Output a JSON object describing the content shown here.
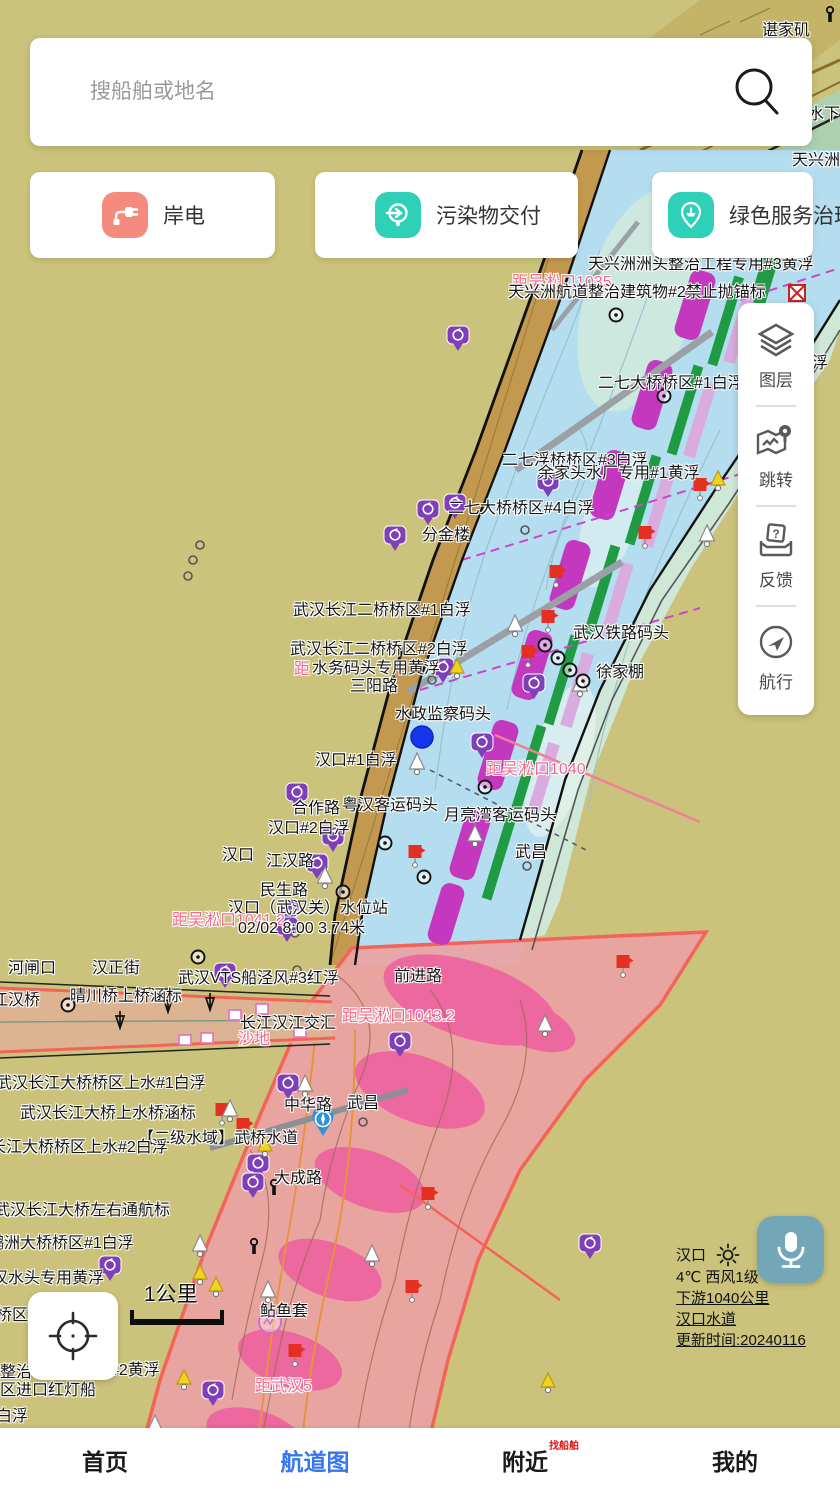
{
  "search": {
    "placeholder": "搜船舶或地名",
    "icon": "search-icon"
  },
  "quick_actions": [
    {
      "label": "岸电",
      "icon": "shore-power-plug-icon",
      "icon_color": "#f58a7e"
    },
    {
      "label": "污染物交付",
      "icon": "pollutant-delivery-icon",
      "icon_color": "#2ed1b8"
    },
    {
      "label": "绿色服务治理",
      "icon": "green-service-ship-icon",
      "icon_color": "#2ed1b8"
    }
  ],
  "tool_panel": [
    {
      "label": "图层",
      "icon": "layers-icon"
    },
    {
      "label": "跳转",
      "icon": "jump-map-pin-icon"
    },
    {
      "label": "反馈",
      "icon": "feedback-inbox-icon"
    },
    {
      "label": "航行",
      "icon": "navigate-compass-icon"
    }
  ],
  "weather": {
    "station": "汉口",
    "weather_icon": "sun-icon",
    "temp_wind": "4℃ 西风1级",
    "downstream": "下游1040公里",
    "waterway": "汉口水道",
    "updated": "更新时间:20240116"
  },
  "scale_bar": {
    "label": "1公里"
  },
  "mic_button": {
    "icon": "microphone-icon",
    "color": "#73a7b7"
  },
  "locate_button": {
    "icon": "crosshair-icon"
  },
  "bottom_nav": [
    {
      "label": "首页",
      "active": false
    },
    {
      "label": "航道图",
      "active": true
    },
    {
      "label": "附近",
      "active": false,
      "badge": "找船舶"
    },
    {
      "label": "我的",
      "active": false
    }
  ],
  "colors": {
    "accent_blue": "#3677f0",
    "distance_pink": "#f0688e",
    "map_bg": "#cbc37b",
    "channel_magenta": "#c438c0",
    "danger_zone": "#e9a3a3"
  },
  "map_labels": [
    {
      "t": "谌家矶",
      "x": 762,
      "y": 22,
      "type": "place"
    },
    {
      "t": "水下",
      "x": 808,
      "y": 106,
      "type": "place"
    },
    {
      "t": "天兴洲",
      "x": 792,
      "y": 152,
      "type": "place"
    },
    {
      "t": "天兴洲洲头整治工程专用#3黄浮",
      "x": 588,
      "y": 256,
      "type": "place"
    },
    {
      "t": "距吴淞口1035",
      "x": 512,
      "y": 274,
      "type": "distance"
    },
    {
      "t": "天兴洲航道整治建筑物#2禁止抛锚标",
      "x": 508,
      "y": 284,
      "type": "place"
    },
    {
      "t": "二七大桥桥区#1白浮",
      "x": 598,
      "y": 375,
      "type": "place"
    },
    {
      "t": "浮",
      "x": 812,
      "y": 355,
      "type": "place"
    },
    {
      "t": "二七浮桥桥区#3白浮",
      "x": 502,
      "y": 452,
      "type": "place"
    },
    {
      "t": "余家头水厂专用#1黄浮",
      "x": 538,
      "y": 465,
      "type": "place"
    },
    {
      "t": "二七大桥桥区#4白浮",
      "x": 448,
      "y": 500,
      "type": "place"
    },
    {
      "t": "分金楼",
      "x": 422,
      "y": 527,
      "type": "place"
    },
    {
      "t": "武汉长江二桥桥区#1白浮",
      "x": 293,
      "y": 602,
      "type": "place"
    },
    {
      "t": "武汉铁路码头",
      "x": 573,
      "y": 625,
      "type": "place"
    },
    {
      "t": "武汉长江二桥桥区#2白浮",
      "x": 290,
      "y": 641,
      "type": "place"
    },
    {
      "t": "距",
      "x": 294,
      "y": 661,
      "type": "distance"
    },
    {
      "t": "水务码头专用黄浮",
      "x": 312,
      "y": 660,
      "type": "place"
    },
    {
      "t": "徐家棚",
      "x": 596,
      "y": 664,
      "type": "place"
    },
    {
      "t": "三阳路",
      "x": 350,
      "y": 678,
      "type": "place"
    },
    {
      "t": "水政监察码头",
      "x": 395,
      "y": 706,
      "type": "place"
    },
    {
      "t": "汉口#1白浮",
      "x": 315,
      "y": 752,
      "type": "place"
    },
    {
      "t": "距吴淞口1040",
      "x": 486,
      "y": 761,
      "type": "distance"
    },
    {
      "t": "合作路",
      "x": 292,
      "y": 800,
      "type": "place"
    },
    {
      "t": "粤汉客运码头",
      "x": 342,
      "y": 797,
      "type": "place"
    },
    {
      "t": "月亮湾客运码头",
      "x": 444,
      "y": 807,
      "type": "place"
    },
    {
      "t": "汉口#2白浮",
      "x": 268,
      "y": 820,
      "type": "place"
    },
    {
      "t": "武昌",
      "x": 515,
      "y": 844,
      "type": "place"
    },
    {
      "t": "汉口",
      "x": 222,
      "y": 847,
      "type": "place"
    },
    {
      "t": "江汉路",
      "x": 266,
      "y": 853,
      "type": "place"
    },
    {
      "t": "民生路",
      "x": 260,
      "y": 882,
      "type": "place"
    },
    {
      "t": "汉口（武汉关）水位站",
      "x": 228,
      "y": 900,
      "type": "place"
    },
    {
      "t": "距吴淞口1041.2",
      "x": 172,
      "y": 912,
      "type": "distance"
    },
    {
      "t": "02/02 8:00 3.74米",
      "x": 238,
      "y": 920,
      "type": "place"
    },
    {
      "t": "河闸口",
      "x": 8,
      "y": 960,
      "type": "place"
    },
    {
      "t": "汉正街",
      "x": 92,
      "y": 960,
      "type": "place"
    },
    {
      "t": "武汉VTS船泾风#3红浮",
      "x": 178,
      "y": 970,
      "type": "place"
    },
    {
      "t": "前进路",
      "x": 394,
      "y": 968,
      "type": "place"
    },
    {
      "t": "晴川桥上桥涵标",
      "x": 70,
      "y": 988,
      "type": "place"
    },
    {
      "t": "江汉桥",
      "x": -8,
      "y": 992,
      "type": "place"
    },
    {
      "t": "长江汉江交汇",
      "x": 240,
      "y": 1015,
      "type": "place"
    },
    {
      "t": "距吴淞口1043.2",
      "x": 342,
      "y": 1008,
      "type": "distance"
    },
    {
      "t": "沙地",
      "x": 238,
      "y": 1031,
      "type": "distance"
    },
    {
      "t": "武汉长江大桥桥区上水#1白浮",
      "x": -4,
      "y": 1075,
      "type": "place"
    },
    {
      "t": "中华路",
      "x": 284,
      "y": 1097,
      "type": "place"
    },
    {
      "t": "武昌",
      "x": 347,
      "y": 1095,
      "type": "place"
    },
    {
      "t": "武汉长江大桥上水桥涵标",
      "x": 20,
      "y": 1105,
      "type": "place"
    },
    {
      "t": "【二级水域】武桥水道",
      "x": 138,
      "y": 1130,
      "type": "place"
    },
    {
      "t": "长江大桥桥区上水#2白浮",
      "x": -10,
      "y": 1139,
      "type": "place"
    },
    {
      "t": "大成路",
      "x": 274,
      "y": 1170,
      "type": "place"
    },
    {
      "t": "武汉长江大桥左右通航标",
      "x": -6,
      "y": 1202,
      "type": "place"
    },
    {
      "t": "鹦洲大桥桥区#1白浮",
      "x": -12,
      "y": 1235,
      "type": "place"
    },
    {
      "t": "汉水头专用黄浮",
      "x": -8,
      "y": 1270,
      "type": "place"
    },
    {
      "t": "桥区",
      "x": -4,
      "y": 1307,
      "type": "place"
    },
    {
      "t": "鲇鱼套",
      "x": 260,
      "y": 1303,
      "type": "place"
    },
    {
      "t": "整治",
      "x": 0,
      "y": 1364,
      "type": "place"
    },
    {
      "t": "#2黄浮",
      "x": 110,
      "y": 1362,
      "type": "place"
    },
    {
      "t": "区进口红灯船",
      "x": 0,
      "y": 1382,
      "type": "place"
    },
    {
      "t": "距武汉5",
      "x": 255,
      "y": 1378,
      "type": "distance"
    },
    {
      "t": "白浮",
      "x": -4,
      "y": 1408,
      "type": "place"
    }
  ],
  "map_markers": [
    {
      "type": "blue-dot",
      "x": 422,
      "y": 737
    },
    {
      "type": "blue-pin",
      "x": 323,
      "y": 1136
    },
    {
      "type": "no-anchor",
      "x": 797,
      "y": 293
    },
    {
      "type": "purple-pin",
      "x": 458,
      "y": 352
    },
    {
      "type": "purple-pin",
      "x": 548,
      "y": 498
    },
    {
      "type": "purple-pin",
      "x": 455,
      "y": 520
    },
    {
      "type": "purple-pin",
      "x": 428,
      "y": 526
    },
    {
      "type": "purple-pin",
      "x": 395,
      "y": 552
    },
    {
      "type": "purple-pin",
      "x": 443,
      "y": 684
    },
    {
      "type": "purple-pin",
      "x": 534,
      "y": 700
    },
    {
      "type": "purple-pin",
      "x": 482,
      "y": 759
    },
    {
      "type": "purple-pin",
      "x": 297,
      "y": 809
    },
    {
      "type": "purple-pin",
      "x": 333,
      "y": 853
    },
    {
      "type": "purple-pin",
      "x": 317,
      "y": 880
    },
    {
      "type": "purple-pin",
      "x": 288,
      "y": 925
    },
    {
      "type": "purple-pin",
      "x": 287,
      "y": 943
    },
    {
      "type": "purple-pin",
      "x": 225,
      "y": 989
    },
    {
      "type": "purple-pin",
      "x": 400,
      "y": 1058
    },
    {
      "type": "purple-pin",
      "x": 288,
      "y": 1100
    },
    {
      "type": "purple-pin",
      "x": 258,
      "y": 1180
    },
    {
      "type": "purple-pin",
      "x": 253,
      "y": 1199
    },
    {
      "type": "purple-pin",
      "x": 110,
      "y": 1282
    },
    {
      "type": "purple-pin",
      "x": 213,
      "y": 1407
    },
    {
      "type": "purple-pin",
      "x": 590,
      "y": 1260
    },
    {
      "type": "red-flag",
      "x": 645,
      "y": 545
    },
    {
      "type": "red-flag",
      "x": 548,
      "y": 629
    },
    {
      "type": "red-flag",
      "x": 528,
      "y": 664
    },
    {
      "type": "red-flag",
      "x": 700,
      "y": 497
    },
    {
      "type": "red-flag",
      "x": 415,
      "y": 864
    },
    {
      "type": "red-flag",
      "x": 623,
      "y": 974
    },
    {
      "type": "red-flag",
      "x": 222,
      "y": 1122
    },
    {
      "type": "red-flag",
      "x": 243,
      "y": 1137
    },
    {
      "type": "red-flag",
      "x": 428,
      "y": 1206
    },
    {
      "type": "red-flag",
      "x": 412,
      "y": 1299
    },
    {
      "type": "red-flag",
      "x": 295,
      "y": 1363
    },
    {
      "type": "red-flag",
      "x": 556,
      "y": 584
    },
    {
      "type": "white-sail",
      "x": 417,
      "y": 768
    },
    {
      "type": "white-sail",
      "x": 515,
      "y": 630
    },
    {
      "type": "white-sail",
      "x": 580,
      "y": 690
    },
    {
      "type": "white-sail",
      "x": 475,
      "y": 840
    },
    {
      "type": "white-sail",
      "x": 325,
      "y": 882
    },
    {
      "type": "white-sail",
      "x": 707,
      "y": 540
    },
    {
      "type": "white-sail",
      "x": 305,
      "y": 1090
    },
    {
      "type": "white-sail",
      "x": 230,
      "y": 1115
    },
    {
      "type": "white-sail",
      "x": 200,
      "y": 1250
    },
    {
      "type": "white-sail",
      "x": 155,
      "y": 1430
    },
    {
      "type": "white-sail",
      "x": 372,
      "y": 1260
    },
    {
      "type": "white-sail",
      "x": 545,
      "y": 1030
    },
    {
      "type": "white-sail",
      "x": 268,
      "y": 1296
    },
    {
      "type": "yellow-warn",
      "x": 718,
      "y": 484
    },
    {
      "type": "yellow-warn",
      "x": 457,
      "y": 672
    },
    {
      "type": "yellow-warn",
      "x": 265,
      "y": 1150
    },
    {
      "type": "yellow-warn",
      "x": 200,
      "y": 1278
    },
    {
      "type": "yellow-warn",
      "x": 216,
      "y": 1290
    },
    {
      "type": "yellow-warn",
      "x": 184,
      "y": 1383
    },
    {
      "type": "yellow-warn",
      "x": 548,
      "y": 1386
    },
    {
      "type": "circle-plus",
      "x": 616,
      "y": 315
    },
    {
      "type": "circle-plus",
      "x": 664,
      "y": 396
    },
    {
      "type": "circle-plus",
      "x": 545,
      "y": 645
    },
    {
      "type": "circle-plus",
      "x": 558,
      "y": 658
    },
    {
      "type": "circle-plus",
      "x": 570,
      "y": 670
    },
    {
      "type": "circle-plus",
      "x": 583,
      "y": 681
    },
    {
      "type": "circle-plus",
      "x": 68,
      "y": 1005
    },
    {
      "type": "circle-plus",
      "x": 198,
      "y": 957
    },
    {
      "type": "circle-plus",
      "x": 343,
      "y": 892
    },
    {
      "type": "circle-plus",
      "x": 424,
      "y": 877
    },
    {
      "type": "circle-plus",
      "x": 485,
      "y": 787
    },
    {
      "type": "circle-plus",
      "x": 385,
      "y": 843
    },
    {
      "type": "dot",
      "x": 200,
      "y": 545
    },
    {
      "type": "dot",
      "x": 193,
      "y": 560
    },
    {
      "type": "dot",
      "x": 188,
      "y": 576
    },
    {
      "type": "dot",
      "x": 295,
      "y": 933
    },
    {
      "type": "dot",
      "x": 432,
      "y": 680
    },
    {
      "type": "dot",
      "x": 525,
      "y": 530
    },
    {
      "type": "dot",
      "x": 527,
      "y": 866
    },
    {
      "type": "dot",
      "x": 363,
      "y": 1122
    },
    {
      "type": "dot",
      "x": 297,
      "y": 970
    },
    {
      "type": "bollard",
      "x": 274,
      "y": 1195
    },
    {
      "type": "bollard",
      "x": 254,
      "y": 1254
    },
    {
      "type": "bollard",
      "x": 830,
      "y": 22
    },
    {
      "type": "magenta-circle",
      "x": 270,
      "y": 1322
    },
    {
      "type": "ss-tag",
      "x": 235,
      "y": 1015
    },
    {
      "type": "ss-tag",
      "x": 262,
      "y": 1009
    },
    {
      "type": "ss-tag",
      "x": 207,
      "y": 1038
    },
    {
      "type": "ss-tag",
      "x": 185,
      "y": 1040
    },
    {
      "type": "ss-tag",
      "x": 300,
      "y": 1032
    },
    {
      "type": "tower",
      "x": 168,
      "y": 1012
    },
    {
      "type": "tower",
      "x": 210,
      "y": 1010
    },
    {
      "type": "tower",
      "x": 120,
      "y": 1028
    }
  ]
}
